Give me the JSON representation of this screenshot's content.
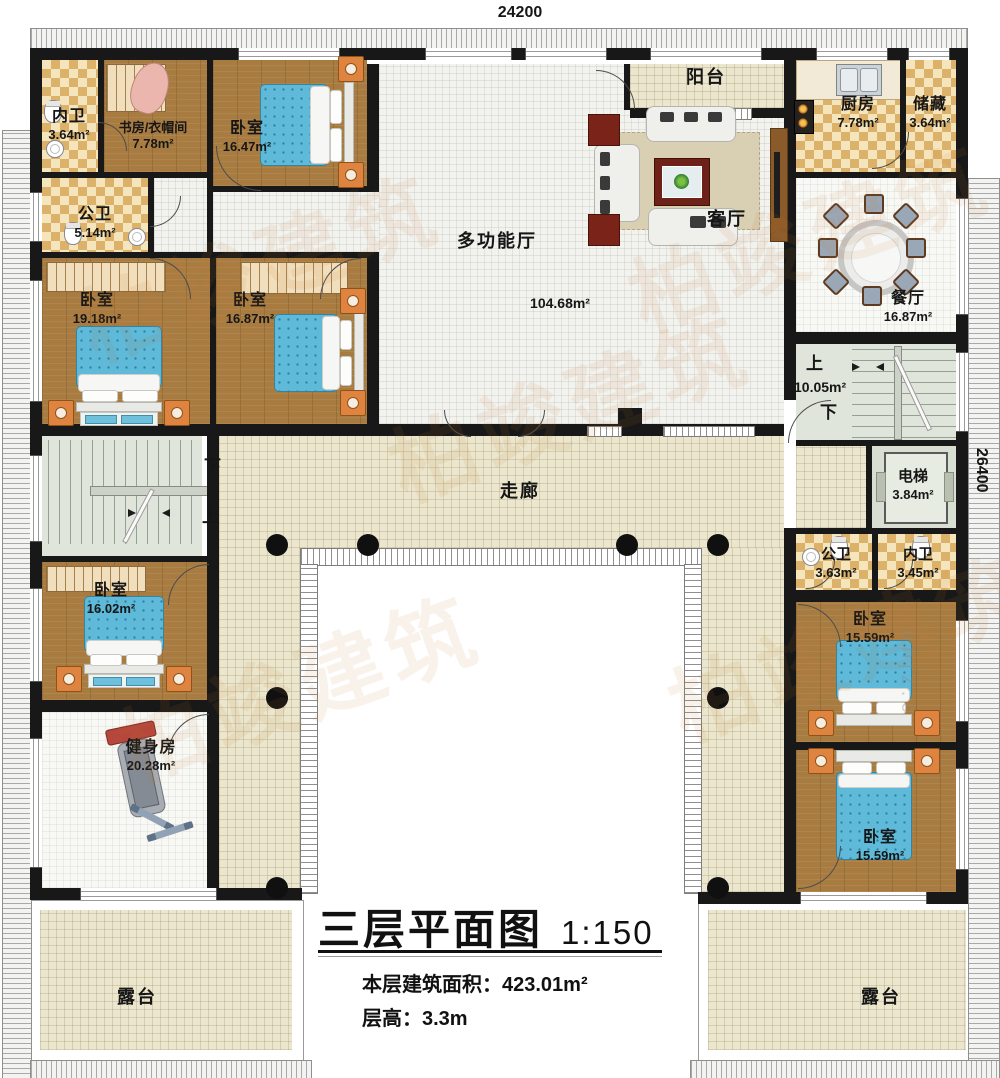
{
  "dimensions": {
    "top": "24200",
    "right": "26400"
  },
  "title": {
    "main": "三层平面图",
    "scale": "1:150",
    "area_label": "本层建筑面积：",
    "area_value": "423.01m²",
    "height_label": "层高：",
    "height_value": "3.3m"
  },
  "watermark": {
    "brand": "柏竣建筑",
    "letters": "unjz.c"
  },
  "colors": {
    "wall": "#181818",
    "wood_floor": "#a87c41",
    "tile_checker": "#dcb169",
    "corridor_beige": "#ebe6cd",
    "hall_light": "#f2f2ee",
    "stair_green": "#dfe5da",
    "bed_blue": "#5fb9d9",
    "nightstand_orange": "#df8440",
    "watermark_orange": "#c87830"
  },
  "rooms": {
    "neiwei_tl": {
      "name": "内卫",
      "area": "3.64m²"
    },
    "study": {
      "name": "书房/衣帽间",
      "area": "7.78m²"
    },
    "bed_tl": {
      "name": "卧室",
      "area": "16.47m²"
    },
    "gongwei_tl": {
      "name": "公卫",
      "area": "5.14m²"
    },
    "bed_l1": {
      "name": "卧室",
      "area": "19.18m²"
    },
    "bed_l2": {
      "name": "卧室",
      "area": "16.87m²"
    },
    "hall": {
      "name": "多功能厅",
      "area": "104.68m²"
    },
    "balcony": {
      "name": "阳台"
    },
    "living": {
      "name": "客厅"
    },
    "kitchen": {
      "name": "厨房",
      "area": "7.78m²"
    },
    "storage": {
      "name": "储藏",
      "area": "3.64m²"
    },
    "dining": {
      "name": "餐厅",
      "area": "16.87m²"
    },
    "stairs_r": {
      "up": "上",
      "down": "下",
      "area": "10.05m²"
    },
    "elevator": {
      "name": "电梯",
      "area": "3.84m²"
    },
    "gongwei_r": {
      "name": "公卫",
      "area": "3.63m²"
    },
    "neiwei_r": {
      "name": "内卫",
      "area": "3.45m²"
    },
    "corridor": {
      "name": "走廊"
    },
    "stairs_l": {
      "down": "下",
      "up": "上"
    },
    "bed_bl": {
      "name": "卧室",
      "area": "16.02m²"
    },
    "gym": {
      "name": "健身房",
      "area": "20.28m²"
    },
    "bed_r1": {
      "name": "卧室",
      "area": "15.59m²"
    },
    "bed_r2": {
      "name": "卧室",
      "area": "15.59m²"
    },
    "terrace_l": {
      "name": "露台"
    },
    "terrace_r": {
      "name": "露台"
    }
  }
}
